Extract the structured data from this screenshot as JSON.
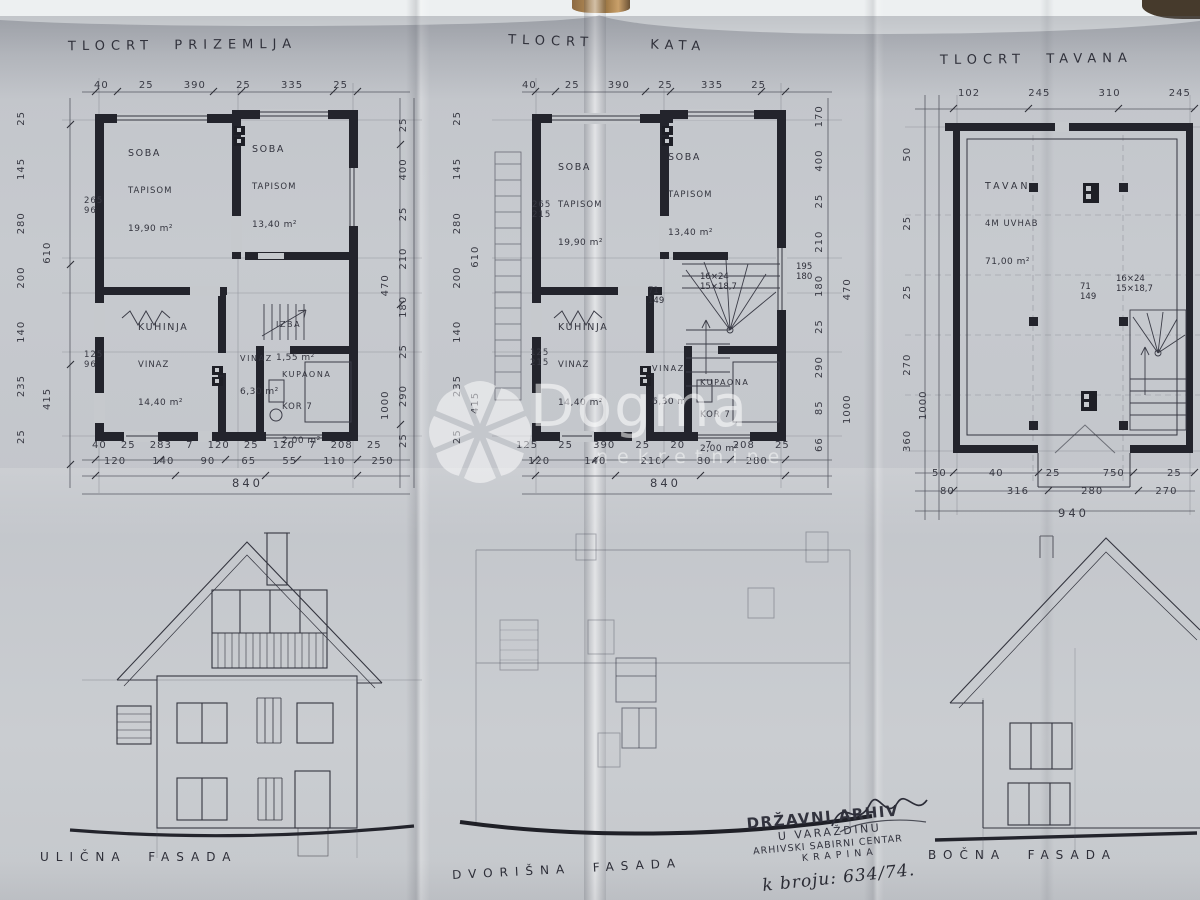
{
  "colors": {
    "paper": "#c6c9cd",
    "ink": "#33343e",
    "wall": "#23242c",
    "pencil": "#4a4c58",
    "wood": "#a97b4a",
    "watermark_white": "#ffffff"
  },
  "watermark": {
    "word": "Dogma",
    "sub": "nekretnine"
  },
  "stamp": {
    "line1": "DRŽAVNI ARHIV",
    "line2": "U VARAŽDINU",
    "line3": "ARHIVSKI SABIRNI CENTAR",
    "line4": "KRAPINA",
    "number": "k broju: 634/74."
  },
  "facades": [
    {
      "label": "ULIČNA  FASADA"
    },
    {
      "label": "DVORIŠNA  FASADA"
    },
    {
      "label": "BOČNA  FASADA"
    }
  ],
  "plans": [
    {
      "title": "TLOCRT  PRIZEMLJA",
      "dims_top": "40 25 390 25 335 25",
      "dims_left": "25 235 140 200 280 145 25",
      "dims_left_total": "415 610",
      "dims_right": "25 290 25 180 210 25 400 25",
      "dims_right_total": "1000 470",
      "dims_bottom_1": "40 25 283 7 120 25 120 7 208 25",
      "dims_bottom_2": "120 140 90 65 55 110 250",
      "total": "840",
      "dim_a": "265",
      "dim_a2": "96",
      "dim_b": "125",
      "dim_b2": "96",
      "rooms": [
        {
          "name": "SOBA",
          "floor": "TAPISOM",
          "area": "19,90 m²"
        },
        {
          "name": "SOBA",
          "floor": "TAPISOM",
          "area": "13,40 m²"
        },
        {
          "name": "KUHINJA",
          "floor": "VINAZ",
          "area": "14,40 m²"
        },
        {
          "name": "IZBA",
          "floor": "",
          "area": "1,55 m²"
        },
        {
          "name": "VINAZ",
          "floor": "",
          "area": "6,30 m²"
        },
        {
          "name": "KUPAONA",
          "floor": "KOR 7",
          "area": "2,00 m²"
        }
      ]
    },
    {
      "title": "TLOCRT  KATA",
      "dims_top": "40 25 390 25 335 25",
      "dims_left": "25 235 140 200 280 145 25",
      "dims_left_total": "415 610",
      "dims_right": "66 85 290 25 180 210 25 400 170",
      "dims_right_total": "1000 470",
      "dims_bottom_1": "125 25 390 25 20 7 208 25",
      "dims_bottom_2": "120 140 210 80 280",
      "total": "840",
      "dim_a": "265",
      "dim_a2": "215",
      "dim_b": "125",
      "dim_b2": "215",
      "stair_note1": "16×24",
      "stair_note2": "15×18,7",
      "stair_note3": "71",
      "stair_note4": "149",
      "stair_note5": "195",
      "stair_note6": "180",
      "rooms": [
        {
          "name": "SOBA",
          "floor": "TAPISOM",
          "area": "19,90 m²"
        },
        {
          "name": "SOBA",
          "floor": "TAPISOM",
          "area": "13,40 m²"
        },
        {
          "name": "KUHINJA",
          "floor": "VINAZ",
          "area": "14,40 m²"
        },
        {
          "name": "VINAZ",
          "floor": "",
          "area": "6,30 m²"
        },
        {
          "name": "KUPAONA",
          "floor": "KOR 7",
          "area": "2,00 m²"
        }
      ]
    },
    {
      "title": "TLOCRT  TAVANA",
      "dims_top": "102 245 310 245",
      "dims_left": "360 270 25 25 50",
      "dims_left_total": "1000",
      "dims_bottom_1": "50 40 25 750 25",
      "dims_bottom_2": "80 316 280 270",
      "total": "940",
      "stair_note1": "16×24",
      "stair_note2": "15×18,7",
      "stair_note3": "71",
      "stair_note4": "149",
      "room": {
        "name": "TAVAN",
        "floor": "4M UVHAB",
        "area": "71,00 m²"
      }
    }
  ]
}
